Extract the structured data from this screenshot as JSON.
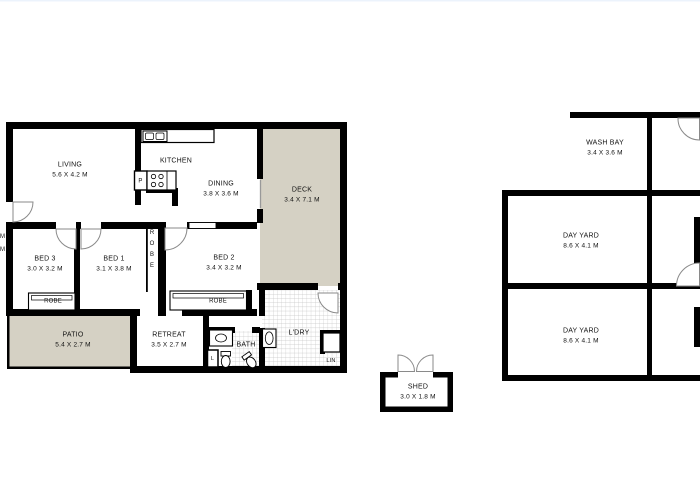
{
  "colors": {
    "wall": "#000000",
    "outdoor_fill": "#d5d1c4",
    "tile_line": "#c4c4c4",
    "door_arc": "#8a8a8a"
  },
  "rooms": {
    "living": {
      "name": "LIVING",
      "dims": "5.6 X 4.2 M"
    },
    "kitchen": {
      "name": "KITCHEN"
    },
    "dining": {
      "name": "DINING",
      "dims": "3.8 X 3.6 M"
    },
    "deck": {
      "name": "DECK",
      "dims": "3.4 X 7.1 M"
    },
    "bed3": {
      "name": "BED 3",
      "dims": "3.0 X 3.2 M"
    },
    "bed1": {
      "name": "BED 1",
      "dims": "3.1 X 3.8 M"
    },
    "bed2": {
      "name": "BED 2",
      "dims": "3.4 X 3.2 M"
    },
    "retreat": {
      "name": "RETREAT",
      "dims": "3.5 X 2.7 M"
    },
    "patio": {
      "name": "PATIO",
      "dims": "5.4 X 2.7 M"
    },
    "bath": {
      "name": "BATH"
    },
    "laundry": {
      "name": "L'DRY"
    },
    "shed": {
      "name": "SHED",
      "dims": "3.0 X 1.8 M"
    },
    "wash_bay": {
      "name": "WASH BAY",
      "dims": "3.4 X 3.6 M"
    },
    "day_yard_top": {
      "name": "DAY YARD",
      "dims": "8.6 X 4.1 M"
    },
    "day_yard_bottom": {
      "name": "DAY YARD",
      "dims": "8.6 X 4.1 M"
    }
  },
  "closets": {
    "robe_bed3": "ROBE",
    "robe_bed1": "ROBE",
    "robe_bed2": "ROBE",
    "linen": "LIN",
    "linen_small": "L",
    "pantry": "P"
  },
  "edge_clipped_label": {
    "line1": "M",
    "line2": "M"
  }
}
